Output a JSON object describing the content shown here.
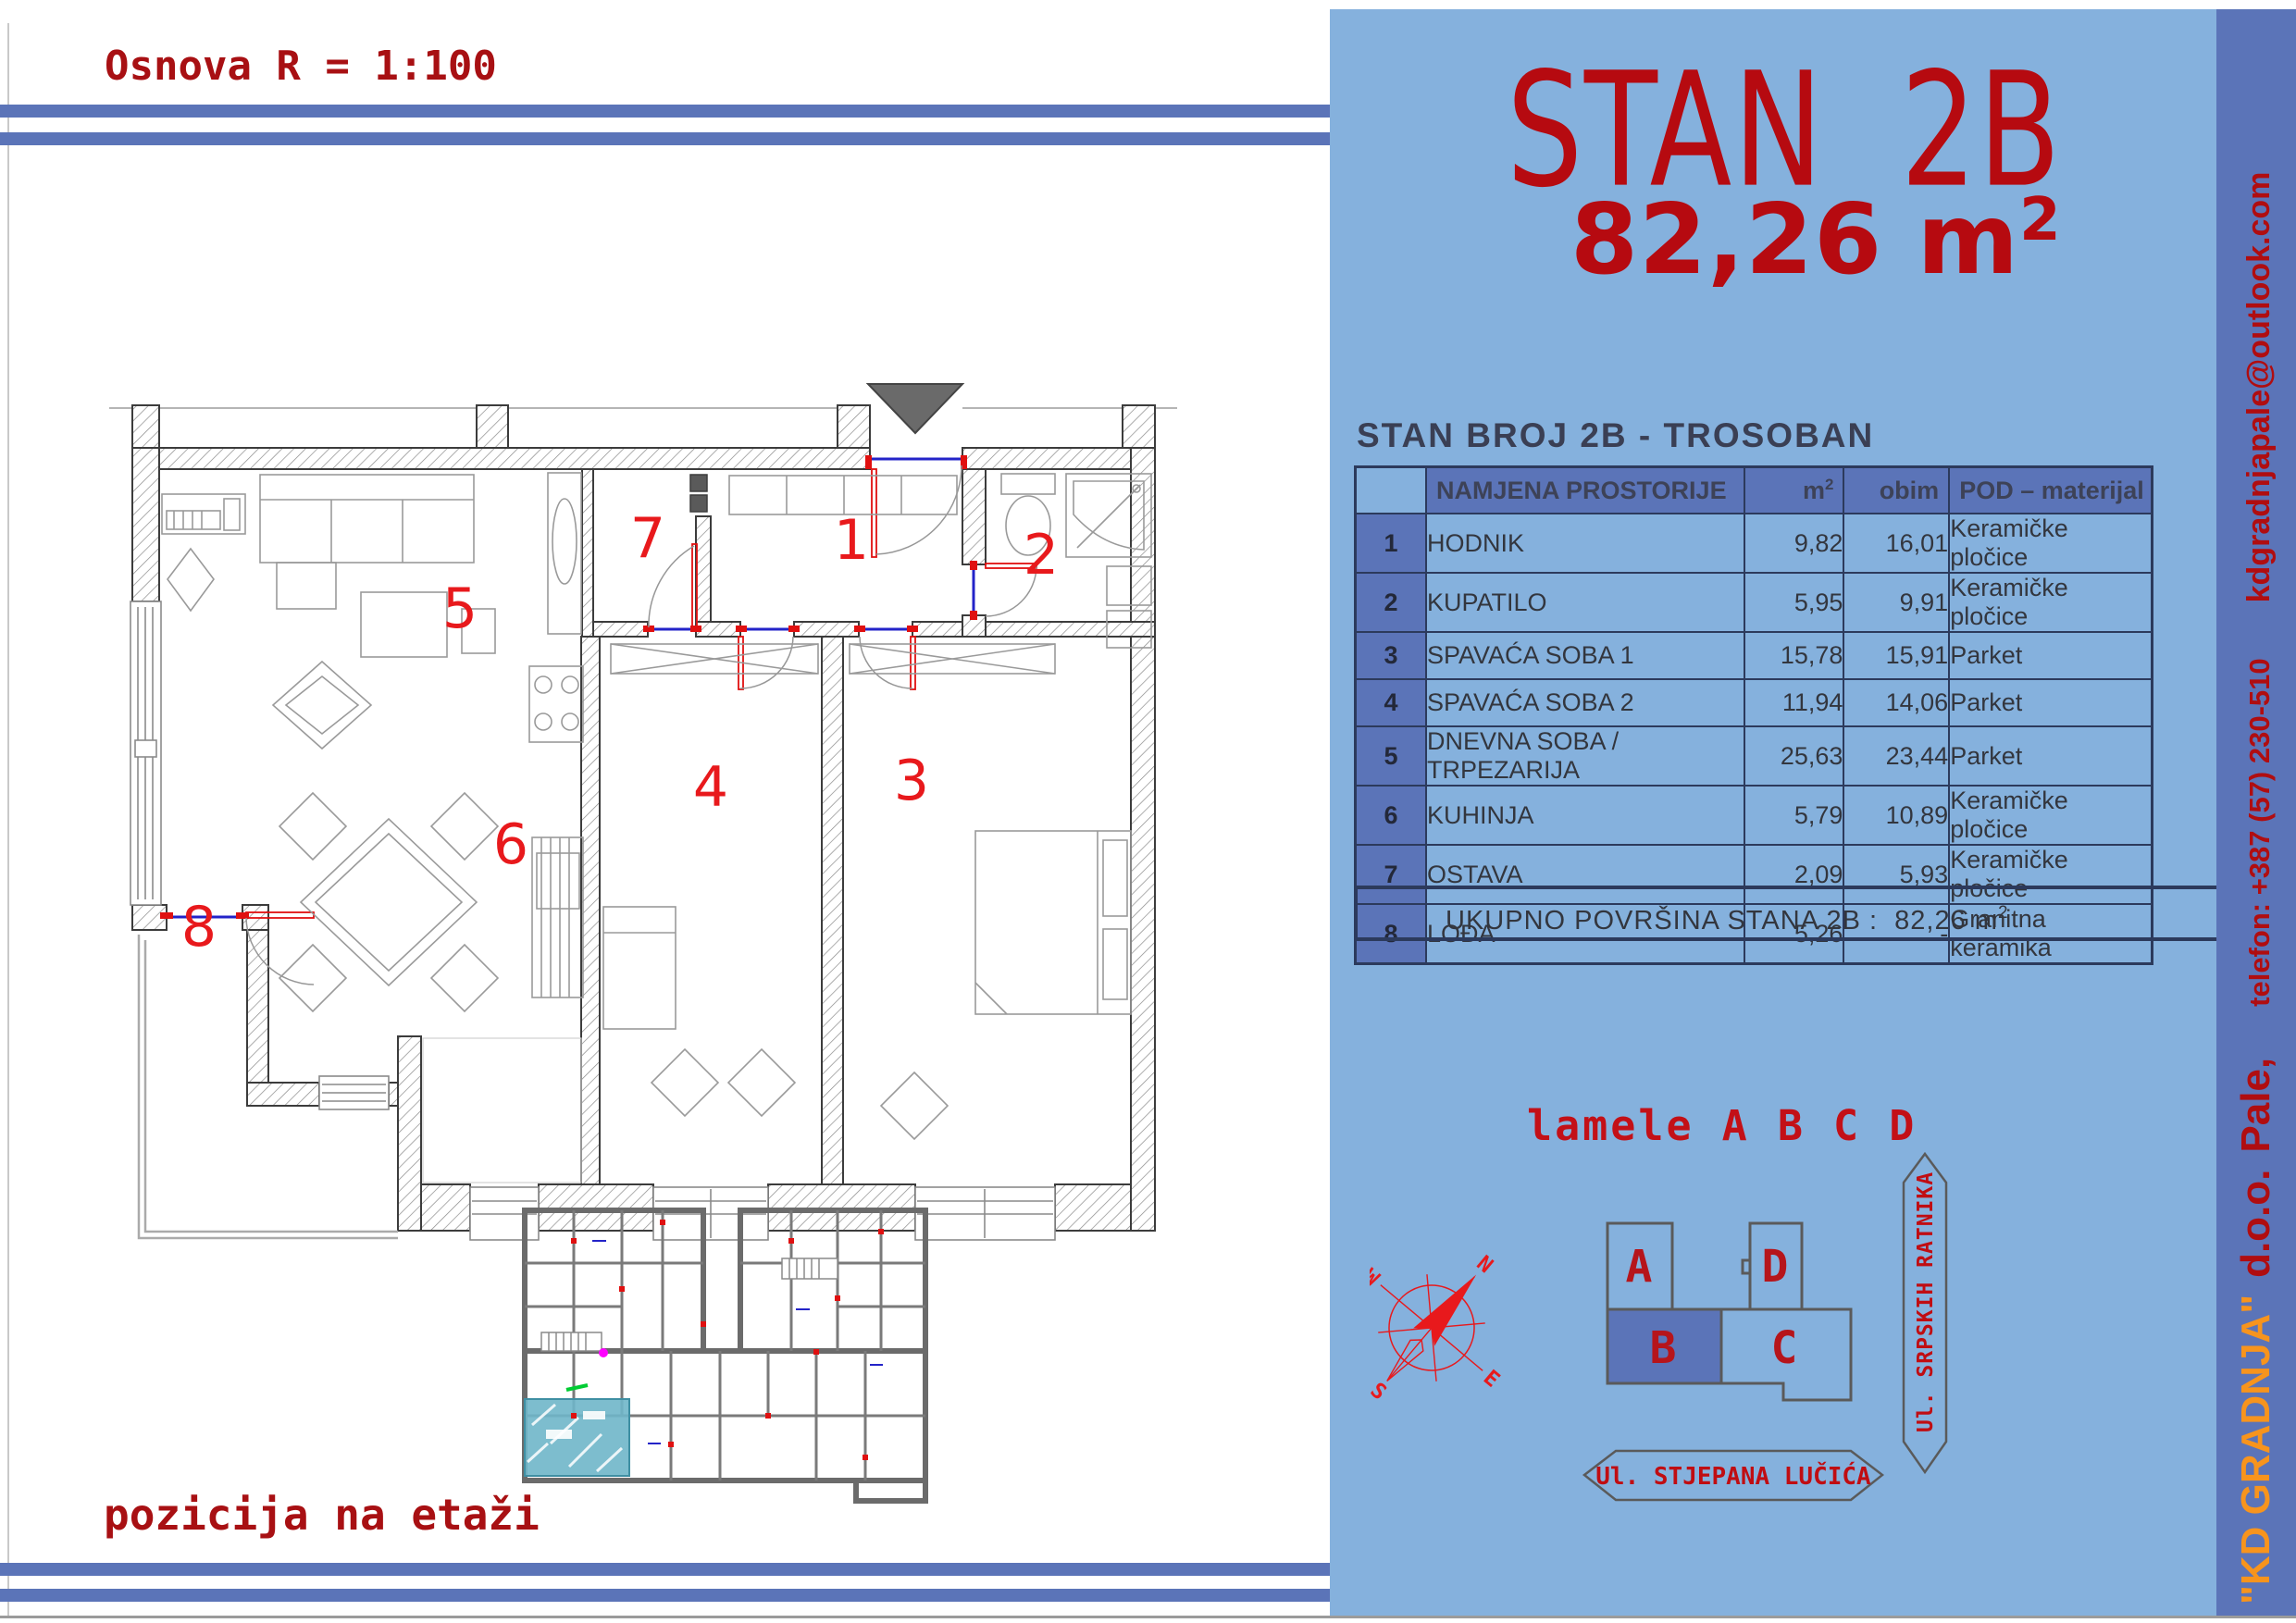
{
  "colors": {
    "panel_bg": "#85b1dd",
    "accent_band": "#5b74b8",
    "table_border": "#2c3a5c",
    "heading_red": "#b60a10",
    "plan_number_red": "#e8191c",
    "company_orange": "#f7941d",
    "highlight_teal": "#6fb6c9"
  },
  "sheet": {
    "scale_title": "Osnova R = 1:100",
    "position_label": "pozicija na etaži"
  },
  "apartment": {
    "name": "STAN 2B",
    "area": "82,26 m",
    "area_sup": "2"
  },
  "table": {
    "title": "STAN BROJ 2B - TROSOBAN",
    "headers": {
      "name": "NAMJENA PROSTORIJE",
      "area": "m",
      "area_sup": "2",
      "perimeter": "obim",
      "floor": "POD – materijal"
    },
    "rows": [
      {
        "num": "1",
        "name": "HODNIK",
        "area": "9,82",
        "perimeter": "16,01",
        "floor": "Keramičke pločice"
      },
      {
        "num": "2",
        "name": "KUPATILO",
        "area": "5,95",
        "perimeter": "9,91",
        "floor": "Keramičke pločice"
      },
      {
        "num": "3",
        "name": "SPAVAĆA SOBA 1",
        "area": "15,78",
        "perimeter": "15,91",
        "floor": "Parket"
      },
      {
        "num": "4",
        "name": "SPAVAĆA SOBA 2",
        "area": "11,94",
        "perimeter": "14,06",
        "floor": "Parket"
      },
      {
        "num": "5",
        "name": "DNEVNA SOBA / TRPEZARIJA",
        "area": "25,63",
        "perimeter": "23,44",
        "floor": "Parket"
      },
      {
        "num": "6",
        "name": "KUHINJA",
        "area": "5,79",
        "perimeter": "10,89",
        "floor": "Keramičke pločice"
      },
      {
        "num": "7",
        "name": "OSTAVA",
        "area": "2,09",
        "perimeter": "5,93",
        "floor": "Keramičke pločice"
      },
      {
        "num": "8",
        "name": "LOĐA",
        "area": "5,26",
        "perimeter": "-",
        "floor": "Granitna keramika"
      }
    ],
    "footer_label": "UKUPNO POVRŠINA STANA  2B :",
    "footer_value": "82,26 m",
    "footer_sup": "2"
  },
  "site": {
    "title": "lamele A B C D",
    "blocks": {
      "a": "A",
      "b": "B",
      "c": "C",
      "d": "D"
    },
    "street_vertical": "Ul. SRPSKIH RATNIKA",
    "street_horizontal": "Ul. STJEPANA LUČIĆA",
    "compass": {
      "n": "N",
      "e": "E",
      "s": "S",
      "w": "W"
    }
  },
  "plan": {
    "rooms": [
      {
        "label": "1"
      },
      {
        "label": "2"
      },
      {
        "label": "3"
      },
      {
        "label": "4"
      },
      {
        "label": "5"
      },
      {
        "label": "6"
      },
      {
        "label": "7"
      },
      {
        "label": "8"
      }
    ]
  },
  "sidebar": {
    "company": "\"KD GRADNJA\"",
    "legal": "d.o.o.",
    "city": "Pale,",
    "phone": "telefon: +387 (57) 230-510",
    "email": "kdgradnjapale@outlook.com"
  }
}
